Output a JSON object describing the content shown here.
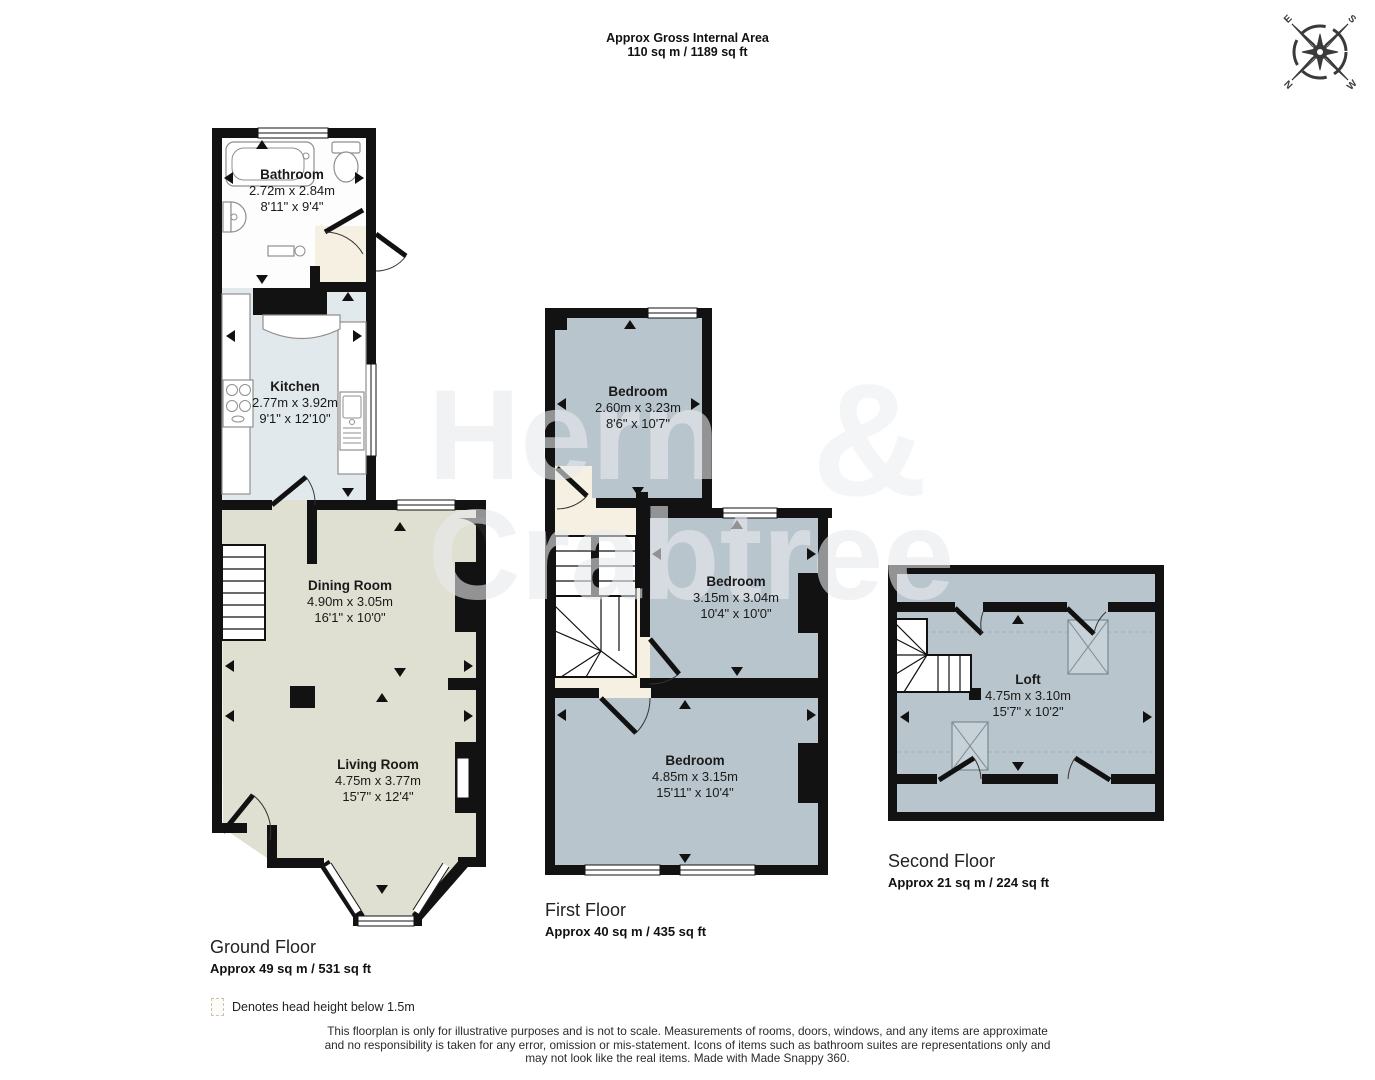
{
  "header": {
    "line1": "Approx Gross Internal Area",
    "line2": "110 sq m / 1189 sq ft"
  },
  "compass": {
    "e": "E",
    "s": "S",
    "w": "W",
    "n": "N"
  },
  "watermark": {
    "word1": "Hern",
    "amp": "&",
    "word2": "Crabtree"
  },
  "floors": [
    {
      "id": "ground",
      "label": "Ground Floor",
      "area": "Approx 49 sq m / 531 sq ft",
      "rooms": [
        {
          "name": "Bathroom",
          "metric": "2.72m x 2.84m",
          "imperial": "8'11\" x 9'4\""
        },
        {
          "name": "Kitchen",
          "metric": "2.77m x 3.92m",
          "imperial": "9'1\" x 12'10\""
        },
        {
          "name": "Dining Room",
          "metric": "4.90m x 3.05m",
          "imperial": "16'1\" x 10'0\""
        },
        {
          "name": "Living Room",
          "metric": "4.75m x 3.77m",
          "imperial": "15'7\" x 12'4\""
        }
      ]
    },
    {
      "id": "first",
      "label": "First Floor",
      "area": "Approx 40 sq m / 435 sq ft",
      "rooms": [
        {
          "name": "Bedroom",
          "metric": "2.60m x 3.23m",
          "imperial": "8'6\" x 10'7\""
        },
        {
          "name": "Bedroom",
          "metric": "3.15m x 3.04m",
          "imperial": "10'4\" x 10'0\""
        },
        {
          "name": "Bedroom",
          "metric": "4.85m x 3.15m",
          "imperial": "15'11\" x 10'4\""
        }
      ]
    },
    {
      "id": "second",
      "label": "Second Floor",
      "area": "Approx 21 sq m / 224 sq ft",
      "rooms": [
        {
          "name": "Loft",
          "metric": "4.75m x 3.10m",
          "imperial": "15'7\" x 10'2\""
        }
      ]
    }
  ],
  "legend": {
    "text": "Denotes head height below 1.5m"
  },
  "disclaimer": {
    "line1": "This floorplan is only for illustrative purposes and is not to scale. Measurements of rooms, doors, windows, and any items are approximate",
    "line2": "and no responsibility is taken for any error, omission or mis-statement. Icons of items such as bathroom suites are representations only and",
    "line3": "may not look like the real items. Made with Made Snappy 360."
  },
  "colors": {
    "wall": "#121212",
    "bathroom_floor": "#fdfdfd",
    "hallway_floor": "#f6f0e2",
    "kitchen_floor": "#e2e9ec",
    "living_floor": "#e0e0d2",
    "bedroom_floor": "#b9c5cd",
    "watermark": "#e7eaec",
    "compass": "#3a3a3a"
  }
}
